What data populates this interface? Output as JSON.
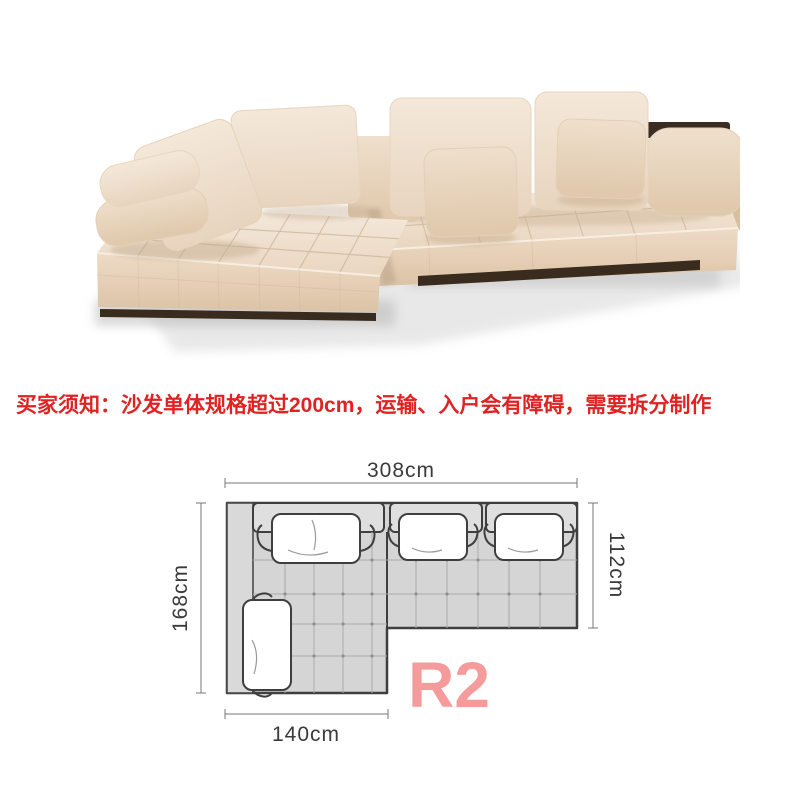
{
  "notice": {
    "text": "买家须知：沙发单体规格超过200cm，运输、入户会有障碍，需要拆分制作",
    "color": "#e02222"
  },
  "diagram": {
    "variant_label": "R2",
    "variant_color": "#f59b9b",
    "dimensions": {
      "width_top": "308cm",
      "depth_right": "112cm",
      "depth_left": "168cm",
      "width_bottom": "140cm"
    },
    "colors": {
      "plan_fill": "#d5d5d5",
      "backrest_fill": "#dfdfdf",
      "outline": "#3f3f3f",
      "grid": "#ababab",
      "pillow": "#ffffff",
      "dim_text": "#3a3a3a"
    }
  },
  "photo_colors": {
    "fabric": "#eedcc7",
    "fabric_shadow": "#dcc3a6",
    "base_plinth": "#3a2b1f",
    "floor_shadow": "#c7c7c7"
  }
}
